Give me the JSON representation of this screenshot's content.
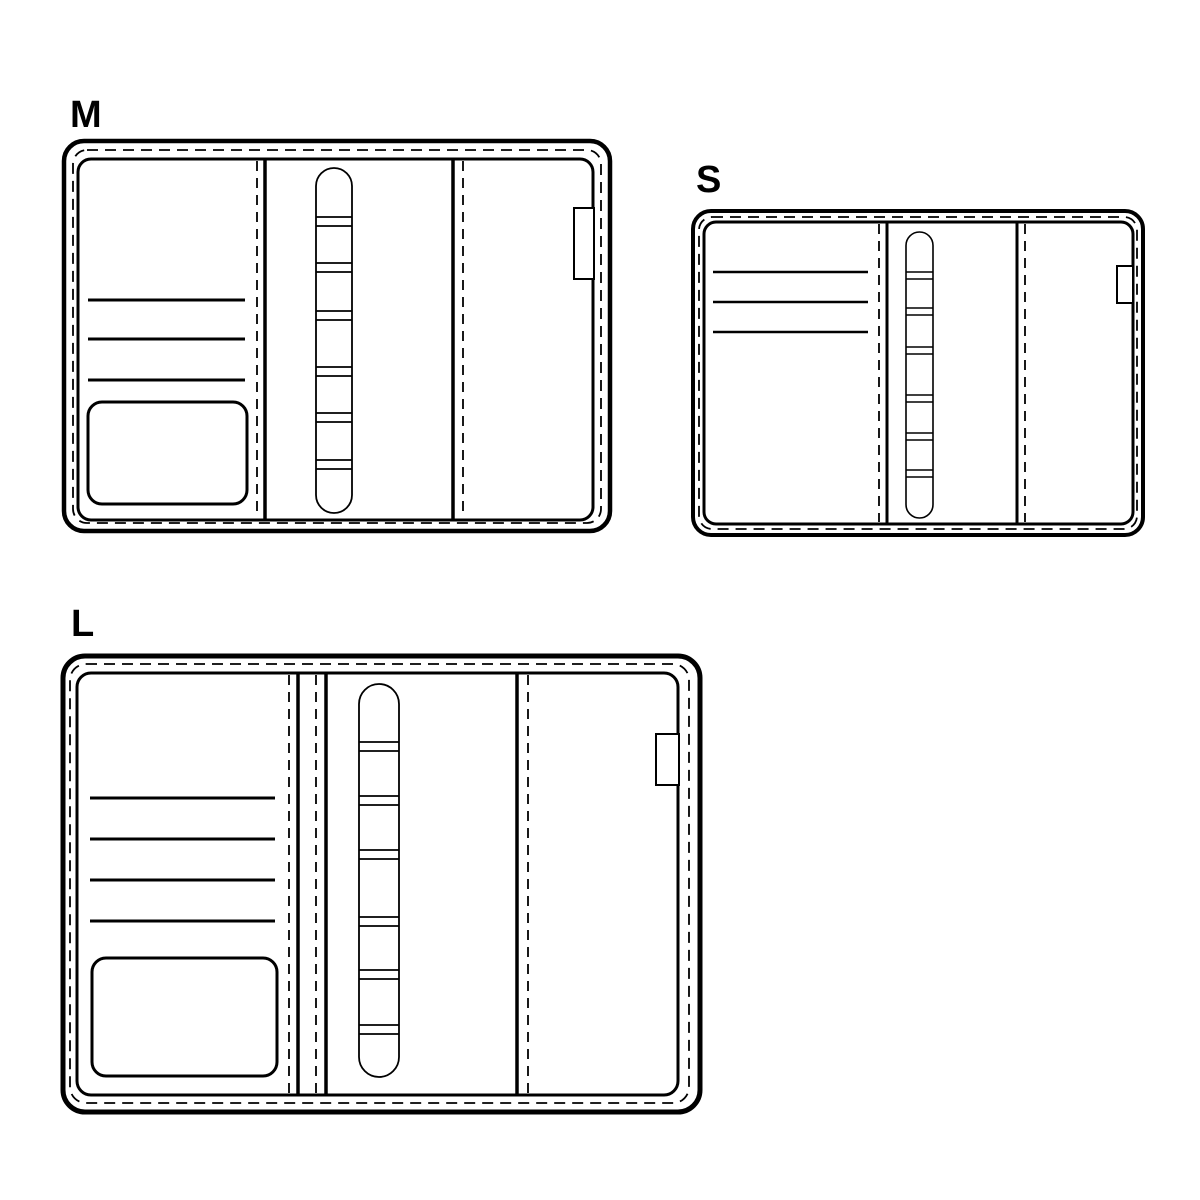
{
  "page": {
    "background_color": "#ffffff",
    "line_color": "#000000"
  },
  "diagrams": [
    {
      "label": "M",
      "card_slot_lines": 3,
      "ring_segments": 6,
      "has_pocket": true,
      "has_pen_loop": true
    },
    {
      "label": "S",
      "card_slot_lines": 3,
      "ring_segments": 6,
      "has_pocket": false,
      "has_pen_loop": true
    },
    {
      "label": "L",
      "card_slot_lines": 4,
      "ring_segments": 6,
      "has_pocket": true,
      "has_pen_loop": true
    }
  ]
}
